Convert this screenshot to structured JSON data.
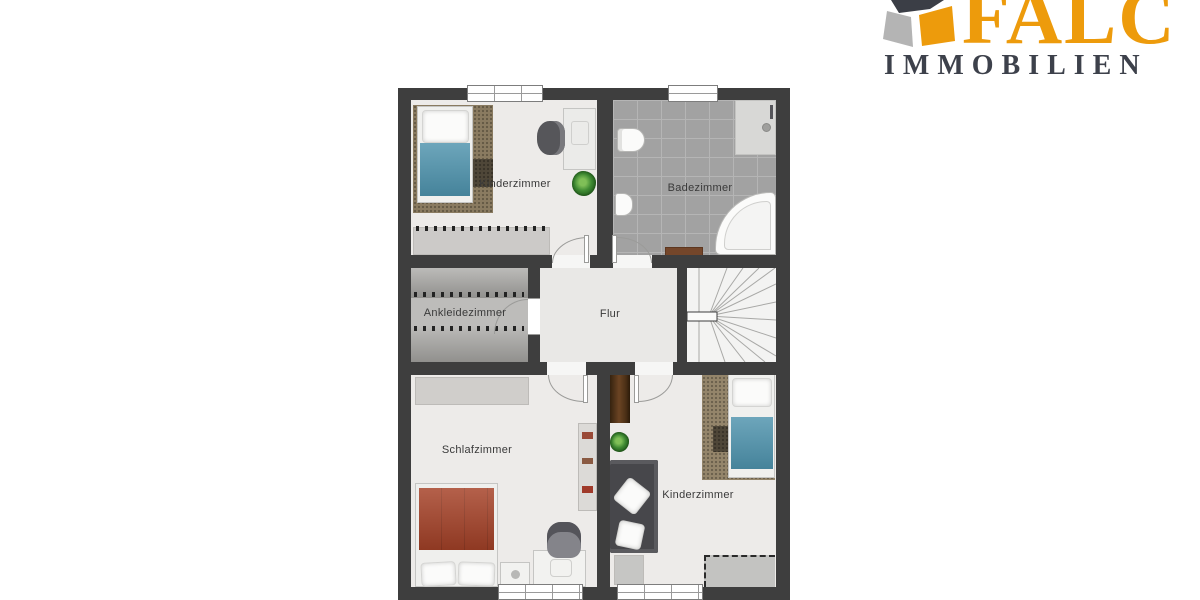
{
  "brand": {
    "primary": "FALC",
    "secondary": "IMMOBILIEN",
    "colors": {
      "orange": "#ED9B0C",
      "dark_gray": "#3D414B",
      "light_gray": "#B4B4B4"
    }
  },
  "floorplan": {
    "colors": {
      "wall": "#3E3E3E",
      "floor": "#EDEBE9",
      "bath_tile": "#A2A2A2",
      "carpet_band": "#A5A4A1",
      "blanket_blue": "#4D92AC",
      "duvet_red": "#A64228",
      "rug_tan": "#8A7B60",
      "sofa_gray": "#47474B",
      "wood_brown": "#6B4423"
    },
    "rooms": {
      "kinderzimmer_top": {
        "label": "Kinderzimmer"
      },
      "badezimmer": {
        "label": "Badezimmer"
      },
      "ankleidezimmer": {
        "label": "Ankleidezimmer"
      },
      "flur": {
        "label": "Flur"
      },
      "schlafzimmer": {
        "label": "Schlafzimmer"
      },
      "kinderzimmer_bottom": {
        "label": "Kinderzimmer"
      }
    }
  }
}
